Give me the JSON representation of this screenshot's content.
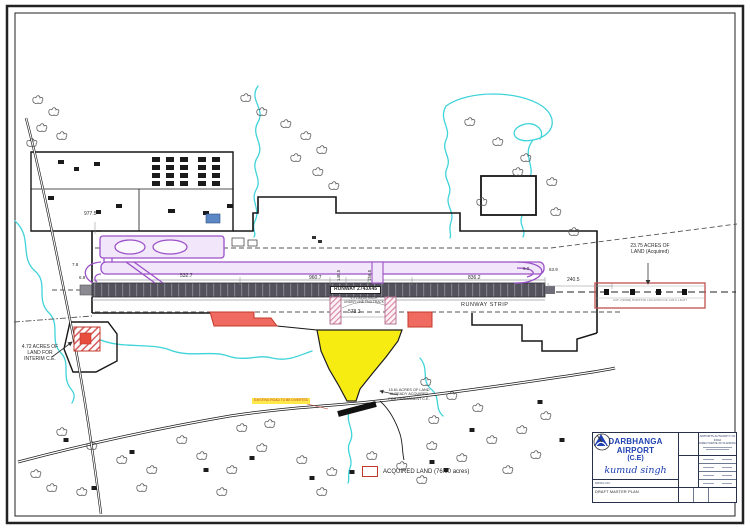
{
  "colors": {
    "stream": "#3fd3da",
    "taxiway_line": "#9b51c8",
    "taxiway_fill": "#f2e7fa",
    "runway_dark": "#54535d",
    "acquired_red": "#ef6a60",
    "land_yellow": "#f6ec12",
    "title_blue": "#1d3fb0"
  },
  "map": {
    "runway_label": "RUNWAY 2743X45",
    "runway_strip_label": "RUNWAY STRIP",
    "note_l1": "4 x 150(55) EACH",
    "note_l2": "UNDER LINE TAXI TRACK",
    "dims": {
      "d977": "977.5",
      "d7_8": "7.8",
      "d6_9": "6.9",
      "d532": "532.7",
      "d960": "960.7",
      "d140": "140.5",
      "d156": "156.5",
      "d836": "836.2",
      "d6_0": "6.0",
      "d63_9": "63.9",
      "d240": "240.5",
      "d578": "578.3"
    },
    "annotations": {
      "interim_l1": "4.72 ACRES OF",
      "interim_l2": "LAND FOR",
      "interim_l3": "INTERIM C.E.",
      "acq_right_l1": "23.75 ACRES OF",
      "acq_right_l2": "LAND (Acquired)",
      "approach_note": "CAT-I (900M) PORTION LOCATION OF CAT-II LIGHT",
      "perm_l1": "15.61 ACRES OF LAND",
      "perm_l2": "ALREADY ACQUIRED",
      "perm_l3": "FOR PERMANENT C.E.",
      "road_note": "EXISTING ROAD TO BE DIVERTED"
    }
  },
  "legend": {
    "acquired_label": "ACQUIRED LAND (76.00 acres)"
  },
  "title_block": {
    "airport_name": "DARBHANGA  AIRPORT",
    "airport_sub": "(C.E)",
    "signature": "kumud singh",
    "drwg_no_label": "DRWG NO.",
    "drawing_title": "DRAFT MASTER PLAN",
    "org_line1": "AIRPORTS AUTHORITY OF INDIA",
    "org_line2": "DIRECTORATE OF PLANNING"
  }
}
